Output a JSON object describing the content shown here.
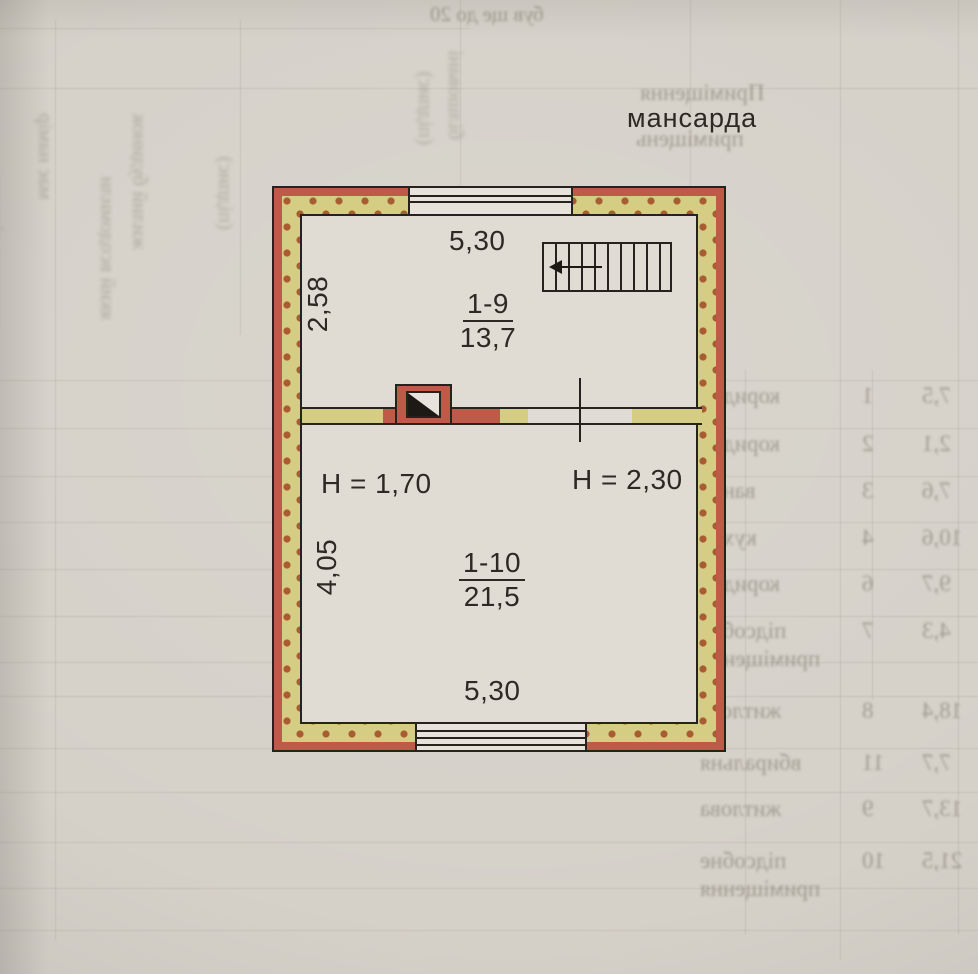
{
  "floor_label": "мансарда",
  "plan": {
    "room_top": {
      "number": "1-9",
      "area": "13,7",
      "width_dim": "5,30",
      "depth_dim": "2,58"
    },
    "room_bottom": {
      "number": "1-10",
      "area": "21,5",
      "width_dim": "5,30",
      "depth_dim": "4,05",
      "ceiling_height_left": "H = 1,70",
      "ceiling_height_right": "H = 2,30"
    }
  },
  "colors": {
    "wall_fill": "#d4cd83",
    "wall_dots": "#a85c31",
    "wall_outer_strip": "#bf5a48",
    "line": "#26221d",
    "paper": "#d5d1c9"
  },
  "bleed_through": {
    "header_lines": [
      {
        "text": "Приміщення",
        "left": 640,
        "top": 80
      },
      {
        "text": "приміщень",
        "left": 636,
        "top": 126
      }
    ],
    "table_rows": [
      {
        "word": "коридор",
        "idx": "1",
        "val": "7,5",
        "top": 383
      },
      {
        "word": "коридор",
        "idx": "2",
        "val": "2,1",
        "top": 431
      },
      {
        "word": "ванна",
        "idx": "3",
        "val": "7,6",
        "top": 478
      },
      {
        "word": "кухня",
        "idx": "4",
        "val": "10,6",
        "top": 525
      },
      {
        "word": "коридор",
        "idx": "6",
        "val": "9,7",
        "top": 571
      },
      {
        "word": "підсобне",
        "idx": "7",
        "val": "4,3",
        "top": 618
      },
      {
        "word": "приміщення",
        "idx": "",
        "val": "",
        "top": 646
      },
      {
        "word": "житлова",
        "idx": "8",
        "val": "18,4",
        "top": 698
      },
      {
        "word": "вбиральня",
        "idx": "11",
        "val": "7,7",
        "top": 750
      },
      {
        "word": "житлова",
        "idx": "9",
        "val": "13,7",
        "top": 796
      },
      {
        "word": "підсобне",
        "idx": "10",
        "val": "21,5",
        "top": 848
      },
      {
        "word": "приміщення",
        "idx": "",
        "val": "",
        "top": 876
      }
    ],
    "side_notes": [
      {
        "text": "висновки вільних",
        "left": 8,
        "top": 330,
        "rot": true
      },
      {
        "text": "має намір",
        "left": 58,
        "top": 200,
        "rot": true
      },
      {
        "text": "який всодомили",
        "left": 120,
        "top": 320,
        "rot": true
      },
      {
        "text": "жилий будинок",
        "left": 152,
        "top": 250,
        "rot": true
      },
      {
        "text": "(підпис)",
        "left": 238,
        "top": 230,
        "rot": true
      },
      {
        "text": "(підпис)",
        "left": 438,
        "top": 145,
        "rot": true
      },
      {
        "text": "білшовані",
        "left": 468,
        "top": 140,
        "rot": true
      },
      {
        "text": "був ще до 20",
        "left": 430,
        "top": 2,
        "rot": false
      }
    ]
  }
}
